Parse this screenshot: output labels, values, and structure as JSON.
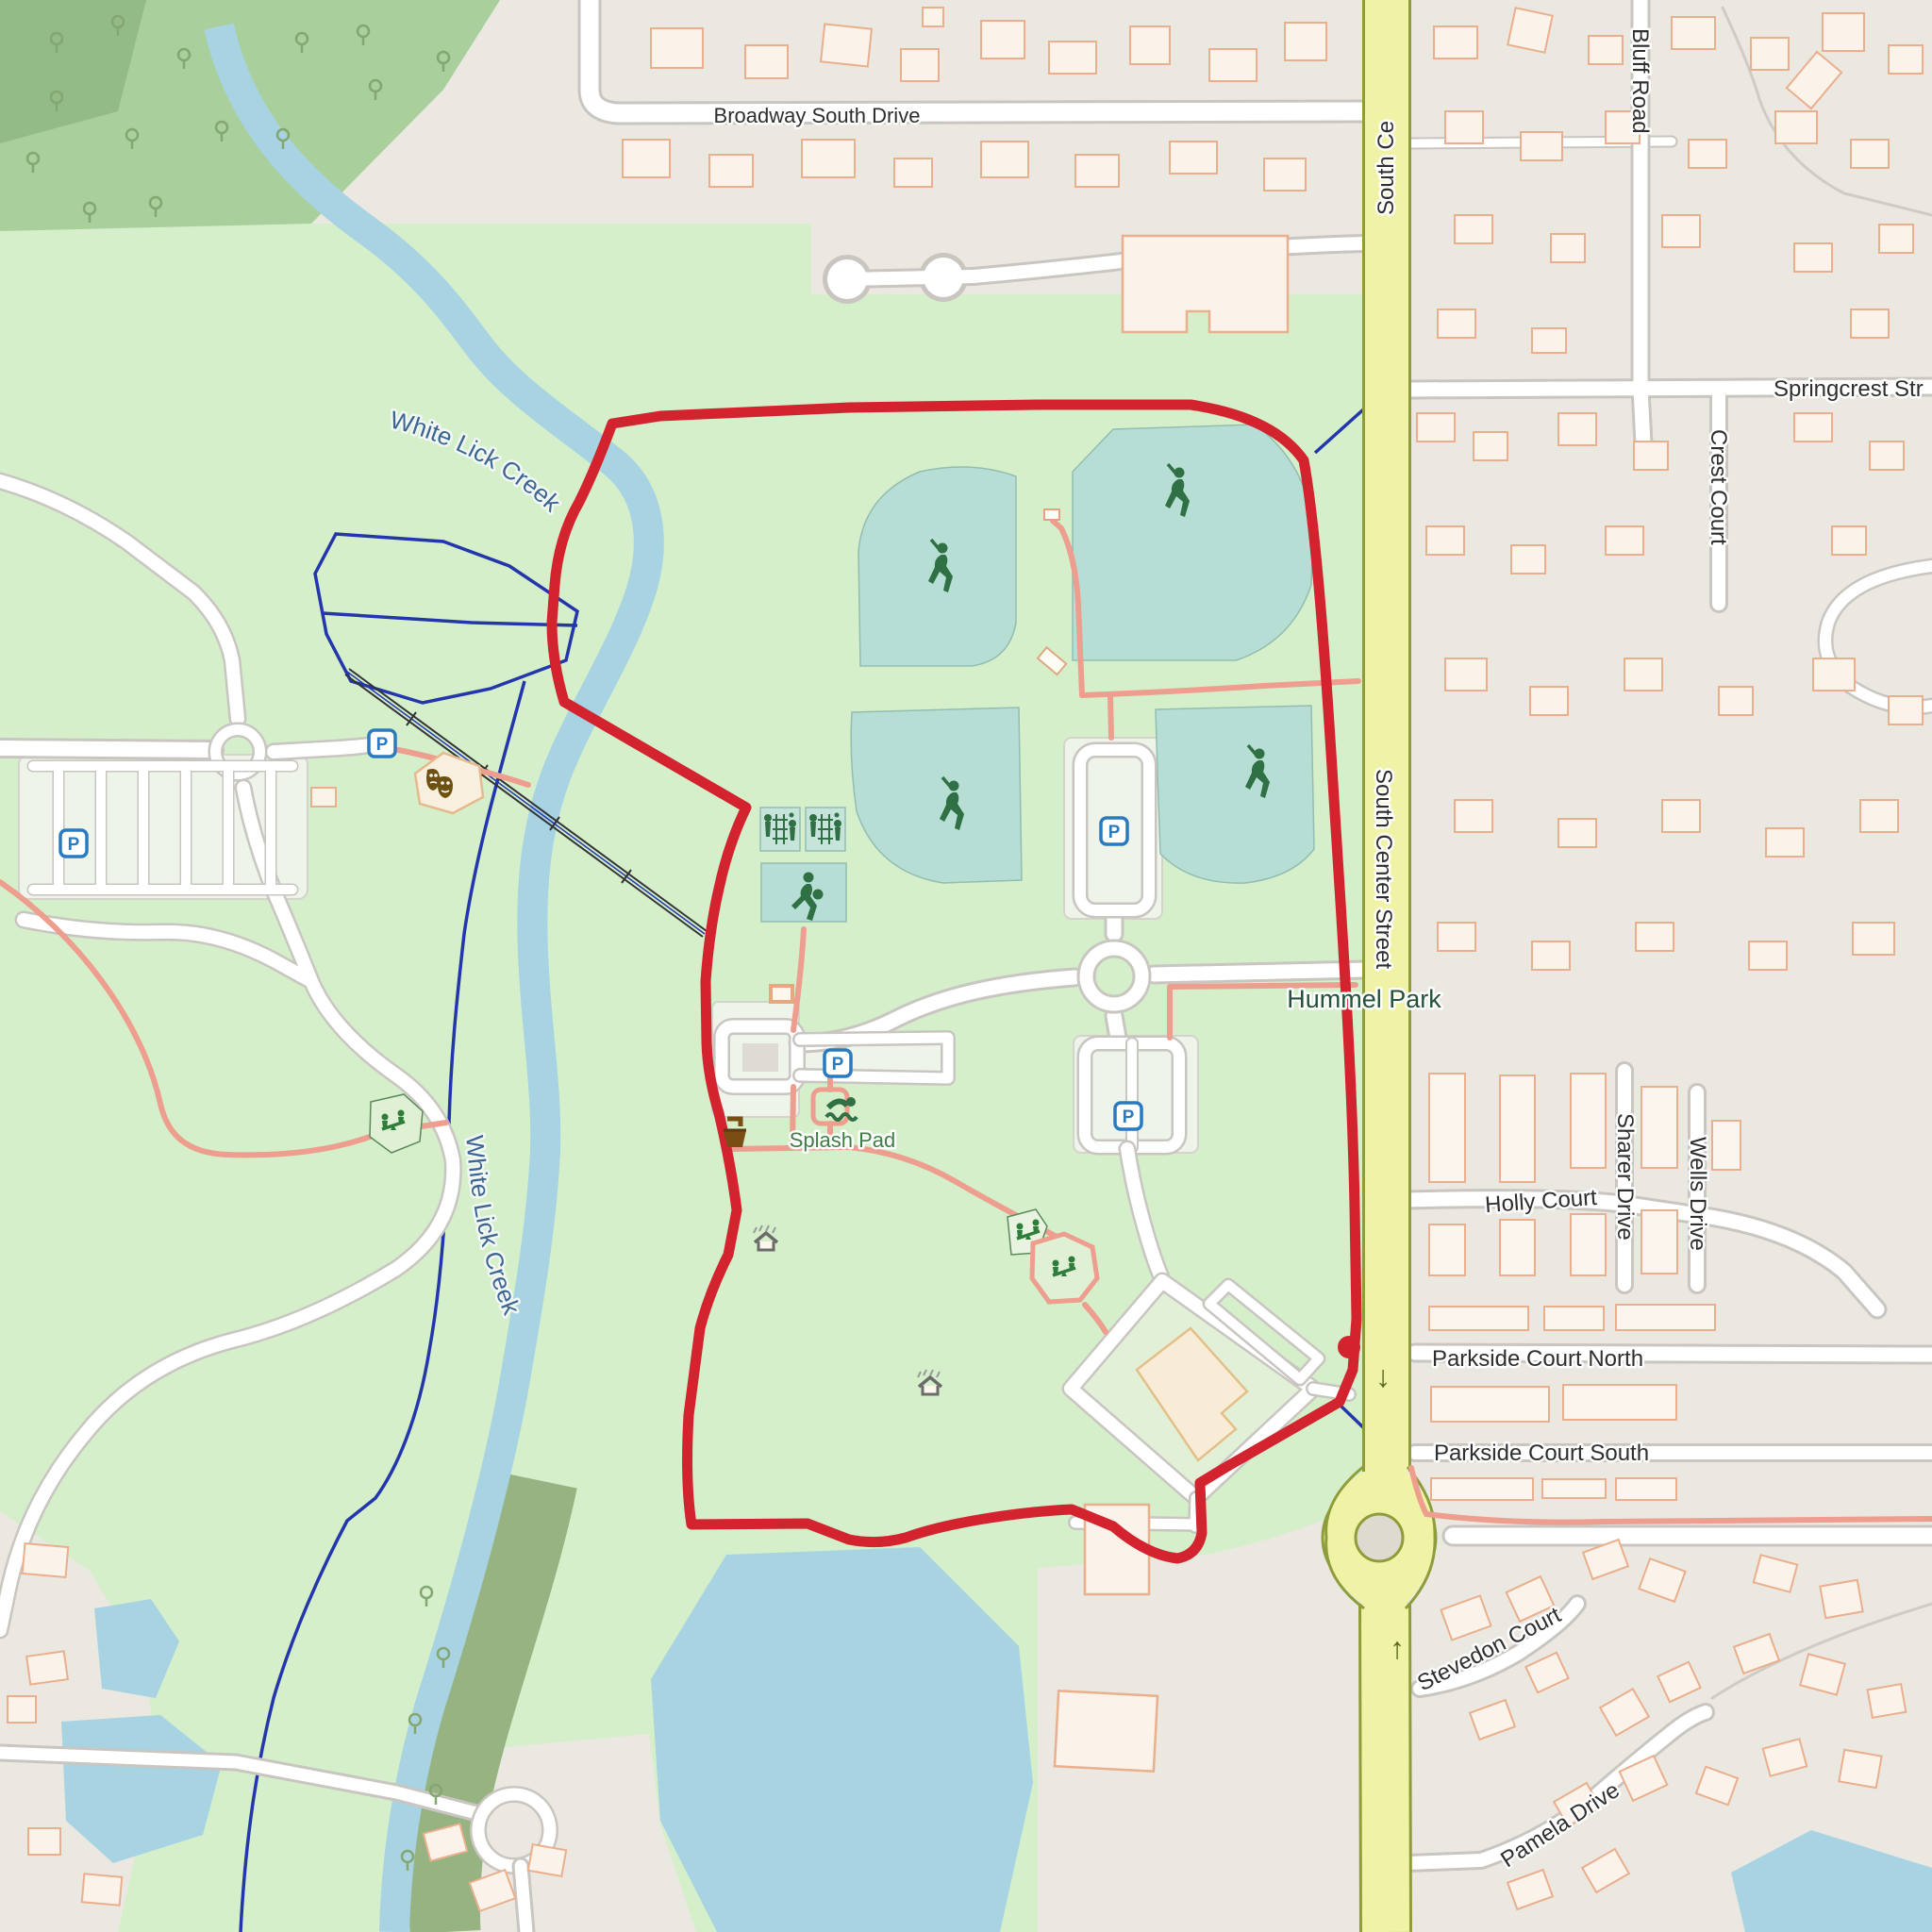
{
  "map": {
    "description": "OpenStreetMap-style map of Hummel Park with a red highlighted route loop",
    "labels": {
      "broadway_south_drive": "Broadway South Drive",
      "south_center_street_top": "South Ce",
      "south_center_street": "South Center Street",
      "bluff_road": "Bluff Road",
      "springcrest_street": "Springcrest Str",
      "crest_court": "Crest Court",
      "white_lick_creek": "White Lick Creek",
      "hummel_park": "Hummel Park",
      "splash_pad": "Splash Pad",
      "holly_court": "Holly Court",
      "sharer_drive": "Sharer Drive",
      "wells_drive": "Wells Drive",
      "parkside_court_north": "Parkside Court North",
      "parkside_court_south": "Parkside Court South",
      "stevedon_court": "Stevedon Court",
      "pamela_drive": "Pamela Drive",
      "parking": "P",
      "oneway_down": "↓",
      "oneway_up": "↑"
    },
    "colors": {
      "park_green": "#d5efcb",
      "forest_green": "#a9cf9d",
      "forest_dark": "#93bb88",
      "woodland": "#97b381",
      "residential_gray": "#ebe7e1",
      "building_fill": "#fbf2e9",
      "building_stroke": "#eaaf8c",
      "road_white": "#ffffff",
      "road_casing": "#c9c5c0",
      "road_yellow": "#f0f2a6",
      "road_yellow_casing": "#8e9c3a",
      "route_red": "#d2232f",
      "footpath_pink": "#ee9e8e",
      "water_fill": "#a8d3e2",
      "water_line_navy": "#2336ac",
      "sport_field_teal": "#b7ded4",
      "icon_green": "#2f7044",
      "parking_blue": "#2a7ac0",
      "icon_brown": "#6d5112"
    },
    "icons": [
      {
        "name": "parking-icon",
        "letter": "P",
        "count": 5
      },
      {
        "name": "baseball-player-icon",
        "count": 4
      },
      {
        "name": "basketball-player-icon",
        "count": 1
      },
      {
        "name": "volleyball-court-icon",
        "count": 2
      },
      {
        "name": "swimmer-icon",
        "count": 1
      },
      {
        "name": "playground-seesaw-icon",
        "count": 3
      },
      {
        "name": "picnic-shelter-icon",
        "count": 2
      },
      {
        "name": "drinking-fountain-icon",
        "count": 1
      },
      {
        "name": "theater-masks-icon",
        "count": 1
      },
      {
        "name": "tree-icon",
        "count": 19
      },
      {
        "name": "oneway-arrow-icon",
        "count": 2
      }
    ]
  }
}
